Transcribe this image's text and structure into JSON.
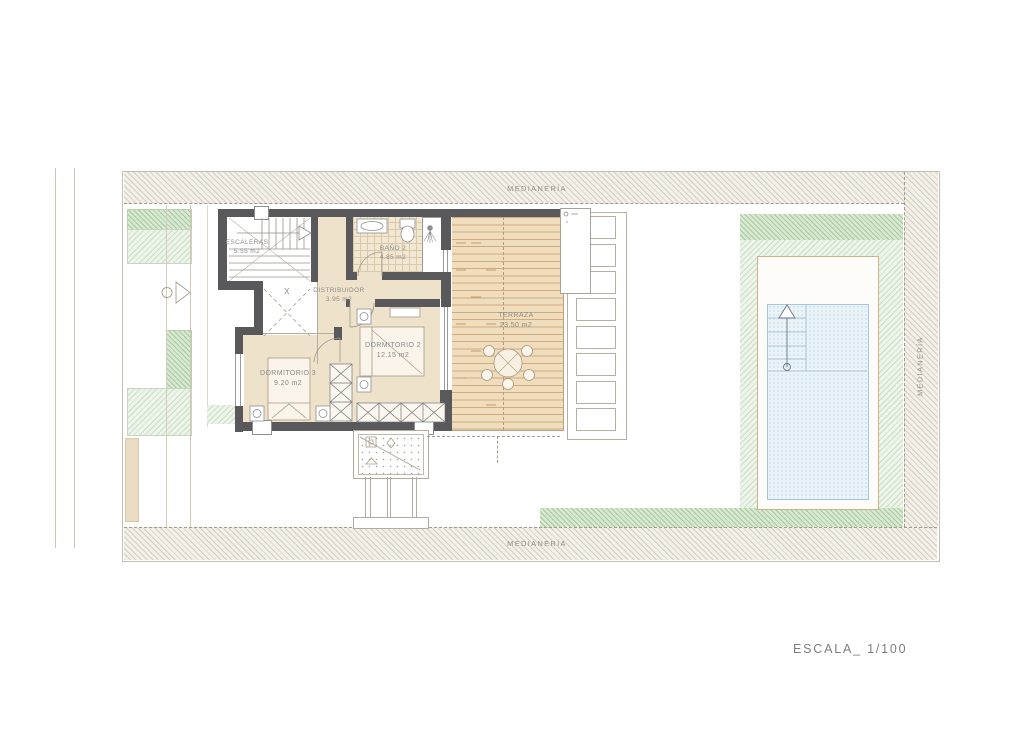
{
  "plan": {
    "scale_label": "ESCALA_ 1/100",
    "void_marker": "X",
    "boundary_labels": {
      "top": "MEDIANERÍA",
      "bottom": "MEDIANERÍA",
      "right": "MEDIANERÍA"
    },
    "rooms": [
      {
        "name": "ESCALERAS",
        "area": "5.55 m2"
      },
      {
        "name": "BAÑO 2",
        "area": "4.85 m2"
      },
      {
        "name": "DISTRIBUIDOR",
        "area": "3.95 m2"
      },
      {
        "name": "DORMITORIO 2",
        "area": "12.15 m2"
      },
      {
        "name": "DORMITORIO 3",
        "area": "9.20 m2"
      },
      {
        "name": "TERRAZA",
        "area": "23.50 m2"
      }
    ],
    "colors": {
      "wall": "#59595b",
      "floor": "#efe2cb",
      "deck": "#efddbd",
      "pool_water": "#e9f3f8",
      "lawn": "#d7e9d0",
      "boundary_hatch": "#f3f0e9",
      "label_text": "#8b8b8b"
    }
  }
}
